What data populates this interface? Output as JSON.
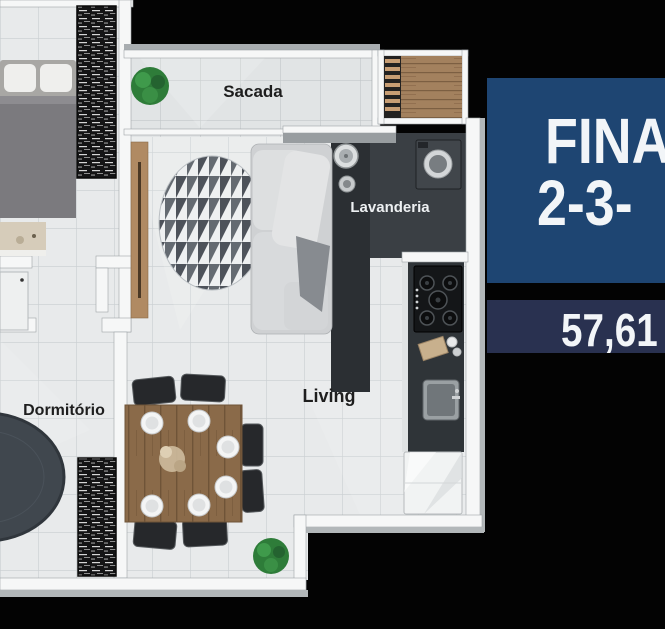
{
  "floor_plan": {
    "room_labels": {
      "sacada": "Sacada",
      "lavanderia": "Lavanderia",
      "living": "Living",
      "dormitorio": "Dormitório"
    }
  },
  "side_panel": {
    "headline_line1": "FINA",
    "headline_line2": "2-3-",
    "area_value": "57,61",
    "headline_bg_color": "#1e4572",
    "area_bg_color": "#293150",
    "text_color": "#f2f5f8"
  }
}
